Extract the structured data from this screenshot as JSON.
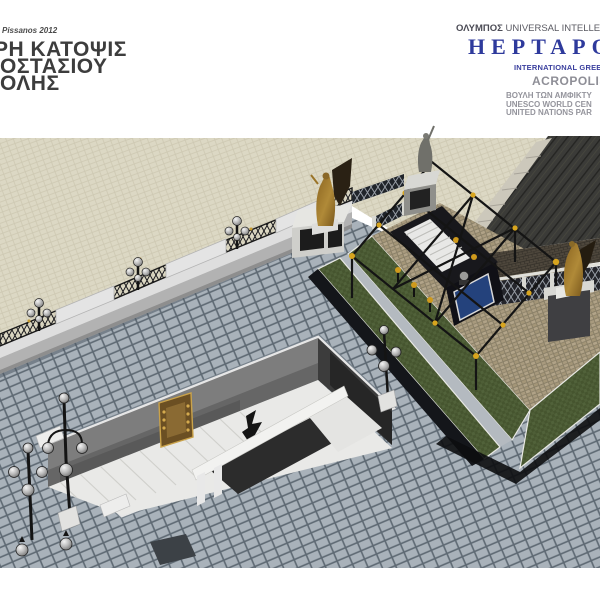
{
  "header_left": {
    "credit": "Pissanos 2012",
    "title_lines": [
      "ΡΗ ΚΑΤΟΨΙΣ",
      "ΟΣΤΑΣΙΟΥ",
      "ΟΛΗΣ"
    ]
  },
  "header_right": {
    "org_greek": "ΟΛΥΜΠΟΣ",
    "org_tagline": " UNIVERSAL INTELLE",
    "brand": "HEPTAPO",
    "brand_sub": "INTERNATIONAL GREEN",
    "site": "ACROPOLIS",
    "caption_lines": [
      "ΒΟΥΛΗ ΤΩΝ ΑΜΦΙΚΤΥ",
      "UNESCO WORLD CEN",
      "UNITED NATIONS PAR"
    ]
  },
  "scene": {
    "alt_text": "Aerial 3D render: tiled plaza with sunken marble stairwell entrance, boundary wall with iron fences and lamps, raised cobblestone platform with black pergola, golden winged statues and grand dark staircase"
  },
  "colors": {
    "brand_blue": "#2e3a9c",
    "caption_gray": "#94949c",
    "plaza_tile": "#a9b2ba",
    "pavement_beige": "#dcd8c4",
    "cobblestone": "#ab9d82",
    "grass": "#4c5c38",
    "stair_dark": "#3b3b38",
    "marble": "#e9e9e7",
    "gold": "#cf9a1c",
    "bronze": "#a07a2c",
    "glass_panel_blue": "#24427c"
  }
}
